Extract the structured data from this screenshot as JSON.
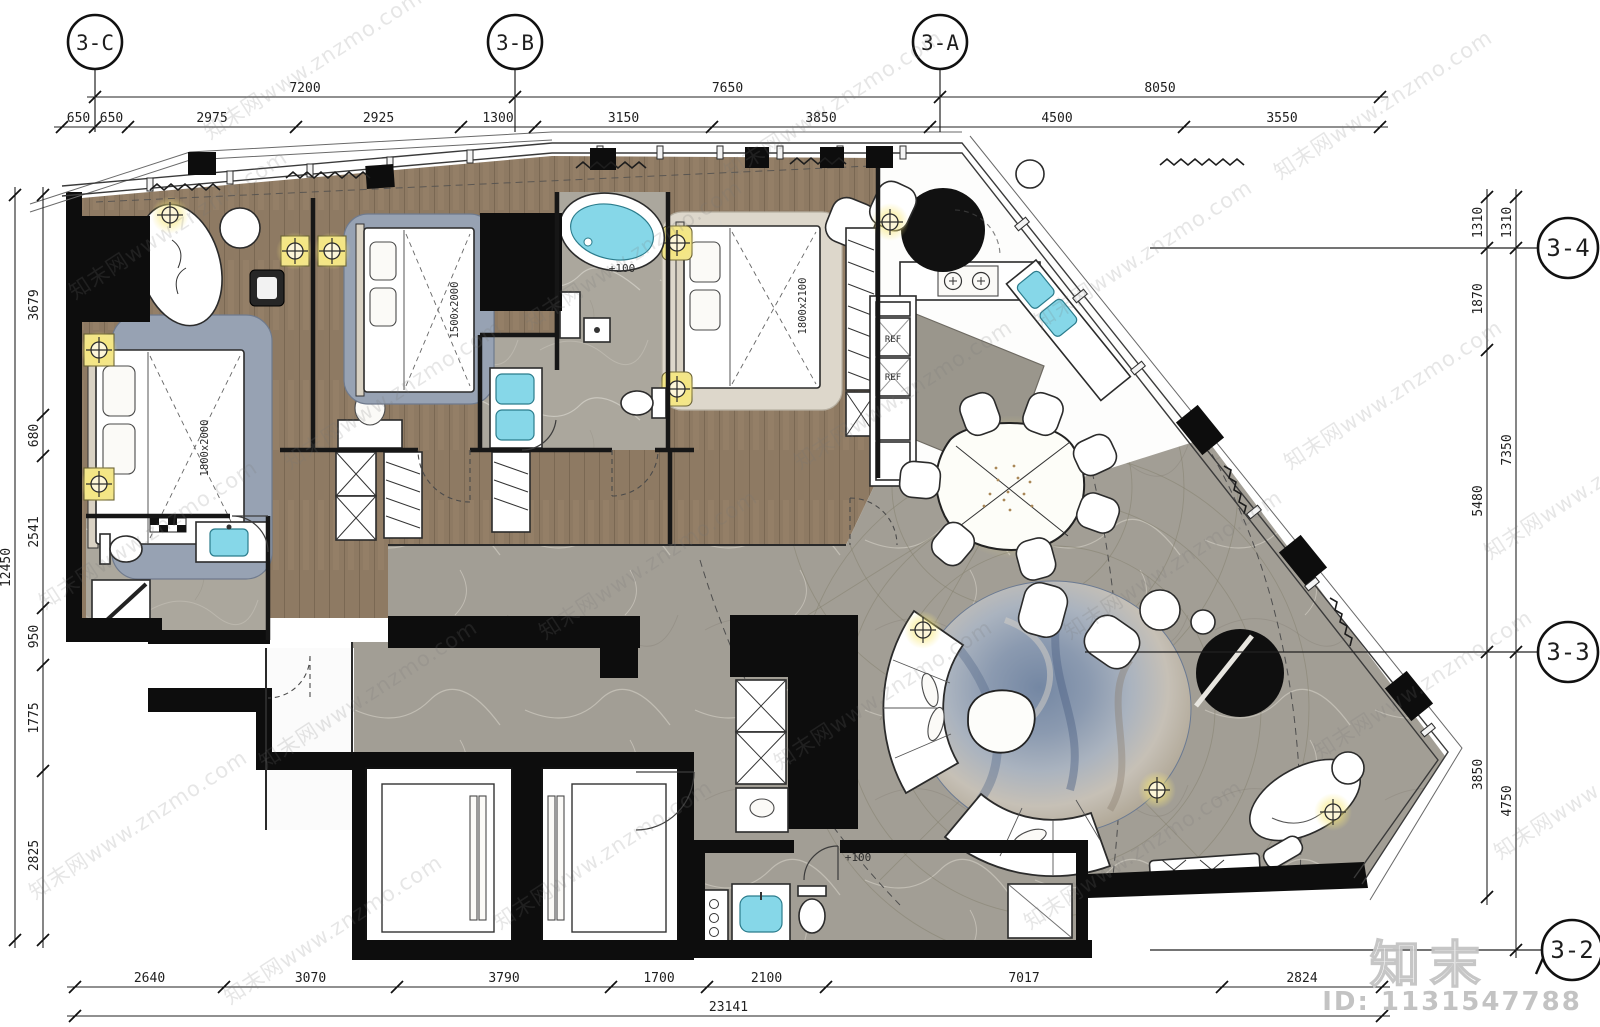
{
  "meta": {
    "title": "hotel-suite-floor-plan",
    "canvas_width": 1600,
    "canvas_height": 1027
  },
  "colors": {
    "wood_floor": "#8e7a63",
    "marble_floor": "#aba79d",
    "stone_floor": "#a29e95",
    "rug_blue": "#97a2b3",
    "rug_round_blue": "#7487a3",
    "fixture_cyan": "#86d7e8",
    "lamp_yellow": "#f2e58c",
    "wall_black": "#0d0d0d",
    "watermark_gray": "#c9c9c9"
  },
  "watermark": {
    "text": "知末网www.znzmo.com",
    "logo_text": "知末",
    "id_label": "ID: 1131547788"
  },
  "grid_bubbles": [
    {
      "label": "3-C",
      "cx": 95,
      "cy": 42,
      "r": 27,
      "type": "top"
    },
    {
      "label": "3-B",
      "cx": 515,
      "cy": 42,
      "r": 27,
      "type": "top"
    },
    {
      "label": "3-A",
      "cx": 940,
      "cy": 42,
      "r": 27,
      "type": "top"
    },
    {
      "label": "3-4",
      "cx": 1568,
      "cy": 248,
      "r": 30,
      "type": "right",
      "leader_from": 1150
    },
    {
      "label": "3-3",
      "cx": 1568,
      "cy": 652,
      "r": 30,
      "type": "right",
      "leader_from": 1085
    },
    {
      "label": "3-2",
      "cx": 1572,
      "cy": 950,
      "r": 30,
      "type": "right",
      "leader_from": 1150,
      "slash": true
    }
  ],
  "dimensions": {
    "top_total": {
      "orient": "h",
      "pos": 97,
      "segments": [
        {
          "from": 95,
          "to": 515,
          "label": "7200"
        },
        {
          "from": 515,
          "to": 940,
          "label": "7650"
        },
        {
          "from": 940,
          "to": 1380,
          "label": "8050"
        }
      ]
    },
    "top_detail": {
      "orient": "h",
      "pos": 127,
      "segments": [
        {
          "from": 62,
          "to": 95,
          "label": "650"
        },
        {
          "from": 95,
          "to": 128,
          "label": "650"
        },
        {
          "from": 128,
          "to": 296,
          "label": "2975"
        },
        {
          "from": 296,
          "to": 461,
          "label": "2925"
        },
        {
          "from": 461,
          "to": 535,
          "label": "1300"
        },
        {
          "from": 535,
          "to": 712,
          "label": "3150"
        },
        {
          "from": 712,
          "to": 930,
          "label": "3850"
        },
        {
          "from": 930,
          "to": 1184,
          "label": "4500"
        },
        {
          "from": 1184,
          "to": 1380,
          "label": "3550"
        }
      ]
    },
    "left_total": {
      "orient": "v",
      "pos": 15,
      "segments": [
        {
          "from": 195,
          "to": 940,
          "label": "12450"
        }
      ]
    },
    "left_detail": {
      "orient": "v",
      "pos": 43,
      "segments": [
        {
          "from": 195,
          "to": 415,
          "label": "3679"
        },
        {
          "from": 415,
          "to": 456,
          "label": "680"
        },
        {
          "from": 456,
          "to": 608,
          "label": "2541"
        },
        {
          "from": 608,
          "to": 665,
          "label": "950"
        },
        {
          "from": 665,
          "to": 771,
          "label": "1775"
        },
        {
          "from": 771,
          "to": 940,
          "label": "2825"
        }
      ]
    },
    "right_detail": {
      "orient": "v",
      "pos": 1487,
      "segments": [
        {
          "from": 197,
          "to": 248,
          "label": "1310"
        },
        {
          "from": 248,
          "to": 350,
          "label": "1870"
        },
        {
          "from": 350,
          "to": 652,
          "label": "5480"
        },
        {
          "from": 652,
          "to": 897,
          "label": "3850"
        }
      ]
    },
    "right_total": {
      "orient": "v",
      "pos": 1516,
      "segments": [
        {
          "from": 197,
          "to": 248,
          "label": "1310"
        },
        {
          "from": 248,
          "to": 652,
          "label": "7350"
        },
        {
          "from": 652,
          "to": 950,
          "label": "4750"
        }
      ]
    },
    "bottom_detail": {
      "orient": "h",
      "pos": 987,
      "segments": [
        {
          "from": 75,
          "to": 224,
          "label": "2640"
        },
        {
          "from": 224,
          "to": 397,
          "label": "3070"
        },
        {
          "from": 397,
          "to": 611,
          "label": "3790"
        },
        {
          "from": 611,
          "to": 707,
          "label": "1700"
        },
        {
          "from": 707,
          "to": 826,
          "label": "2100"
        },
        {
          "from": 826,
          "to": 1222,
          "label": "7017"
        },
        {
          "from": 1222,
          "to": 1382,
          "label": "2824"
        }
      ]
    },
    "bottom_total": {
      "orient": "h",
      "pos": 1016,
      "segments": [
        {
          "from": 75,
          "to": 1382,
          "label": "23141"
        }
      ]
    }
  },
  "plan_annotations": [
    {
      "text": "1800x2000",
      "x": 208,
      "y": 448,
      "rot": -90,
      "size": 10.5
    },
    {
      "text": "1500x2000",
      "x": 458,
      "y": 310,
      "rot": -90,
      "size": 10.5
    },
    {
      "text": "1800x2100",
      "x": 806,
      "y": 306,
      "rot": -90,
      "size": 10.5
    },
    {
      "text": "REF",
      "x": 893,
      "y": 342,
      "rot": 0,
      "size": 9
    },
    {
      "text": "REF",
      "x": 893,
      "y": 380,
      "rot": 0,
      "size": 9
    },
    {
      "text": "+100",
      "x": 622,
      "y": 272,
      "rot": 0,
      "size": 11
    },
    {
      "text": "+100",
      "x": 858,
      "y": 861,
      "rot": 0,
      "size": 11
    }
  ]
}
